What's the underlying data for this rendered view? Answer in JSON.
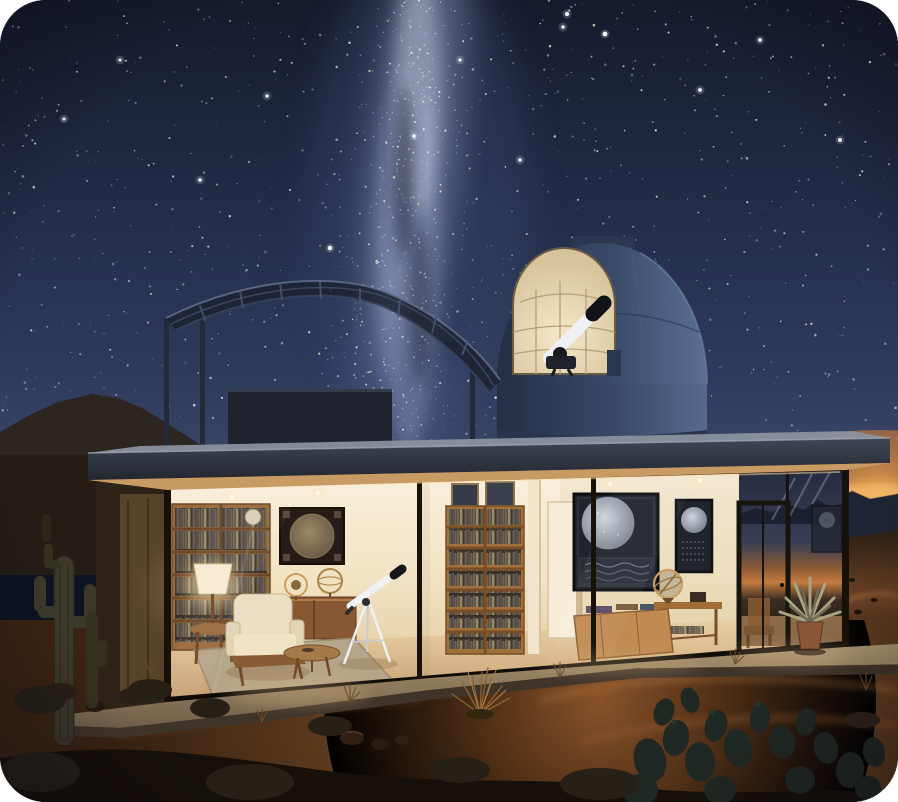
{
  "meta": {
    "title": "Desert observatory house under a starry night sky"
  },
  "palette": {
    "sky_top": "#151b2c",
    "sky_mid": "#232d49",
    "sky_horizon": "#3a4767",
    "milkyway": "#9aa6c8",
    "milkyway_bright": "#c9d0e5",
    "horizon_glow": "#f2a955",
    "mountain_right": "#1d2433",
    "mountain_left": "#2c2520",
    "pergola": "#1c2230",
    "dome_shadow": "#242e45",
    "dome_mid": "#3a4a68",
    "dome_lit": "#5c6f92",
    "dome_opening": "#f4e7c8",
    "dome_opening_edge": "#d8c49c",
    "dome_grid": "#b59f78",
    "roof_fascia": "#3f4655",
    "roof_top": "#8a919e",
    "soffit": "#c99b64",
    "room_ceiling": "#fbf2e1",
    "room_wall": "#f1e2c2",
    "room_floor_lit": "#f0d6ac",
    "room_floor_deep": "#c49e70",
    "wood": "#9a6a3c",
    "wood_dark": "#6b4626",
    "oak_light": "#c08a50",
    "chart_dark": "#20242b",
    "chart_map": "#cfd5de",
    "chart_sepia": "#8a7a62",
    "chart_frame_brown": "#241c15",
    "chair_cream": "#ebdec4",
    "rug": "#b3a48a",
    "telescope_white": "#eff1f4",
    "mullion": "#161209",
    "patio": "#a8926f",
    "patio_face": "#3f342a",
    "sand_lit": "#8a5228",
    "sand_ridge": "#b5773f",
    "sand_dark": "#3a2312",
    "foreground": "#17100a",
    "cactus": "#3c382a",
    "prickly_pear": "#202823",
    "agave": "#a8a482",
    "pot": "#8a5636",
    "lamp_glow": "#ffe3a8",
    "led_strip": "#ffdfa8"
  },
  "stars": {
    "seed": 11,
    "field_count": 900,
    "milkyway_count": 520,
    "colors": [
      "#ffffff",
      "#cfd6e8",
      "#ffe7c2",
      "#9fb0d8"
    ],
    "bright": [
      [
        563,
        27
      ],
      [
        605,
        34
      ],
      [
        567,
        14
      ],
      [
        267,
        96
      ],
      [
        64,
        119
      ],
      [
        414,
        136
      ],
      [
        330,
        248
      ],
      [
        520,
        160
      ],
      [
        700,
        90
      ],
      [
        120,
        60
      ],
      [
        840,
        140
      ],
      [
        200,
        180
      ],
      [
        760,
        40
      ],
      [
        460,
        60
      ]
    ]
  }
}
